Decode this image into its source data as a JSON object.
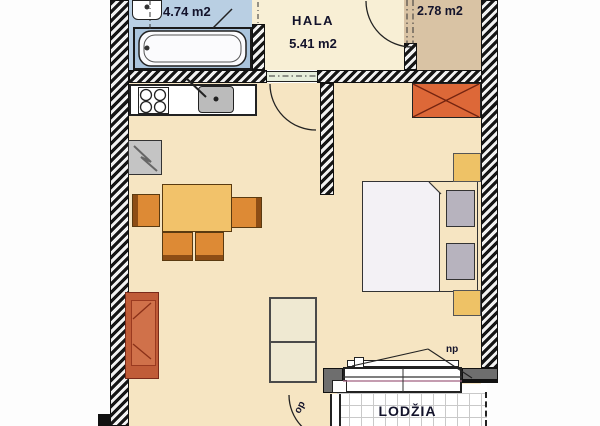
{
  "plan": {
    "rooms": {
      "bathroom": {
        "area": "4.74 m2"
      },
      "hall": {
        "name": "HALA",
        "area": "5.41 m2"
      },
      "storage": {
        "area": "2.78 m2"
      },
      "loggia": {
        "name": "LODŽIA"
      }
    },
    "labels": {
      "window": "np",
      "balcony_door": "op"
    },
    "colors": {
      "bathroom_floor": "#b9cfe3",
      "tub_zone": "#aac4dc",
      "hall_floor": "#f8efd5",
      "storage_floor": "#d9c3a4",
      "room_floor": "#f6e5c2",
      "wall_dark": "#161616",
      "pier_gray": "#6e6e6e",
      "table": "#f2c26a",
      "chair": "#dd8a35",
      "armchair": "#c05c38",
      "wardrobe_shaft": "#dd6838",
      "nightstand": "#eec266",
      "pillow": "#b7b3be",
      "door_sill": "#e6eedb",
      "window_accent": "#a06080"
    }
  }
}
